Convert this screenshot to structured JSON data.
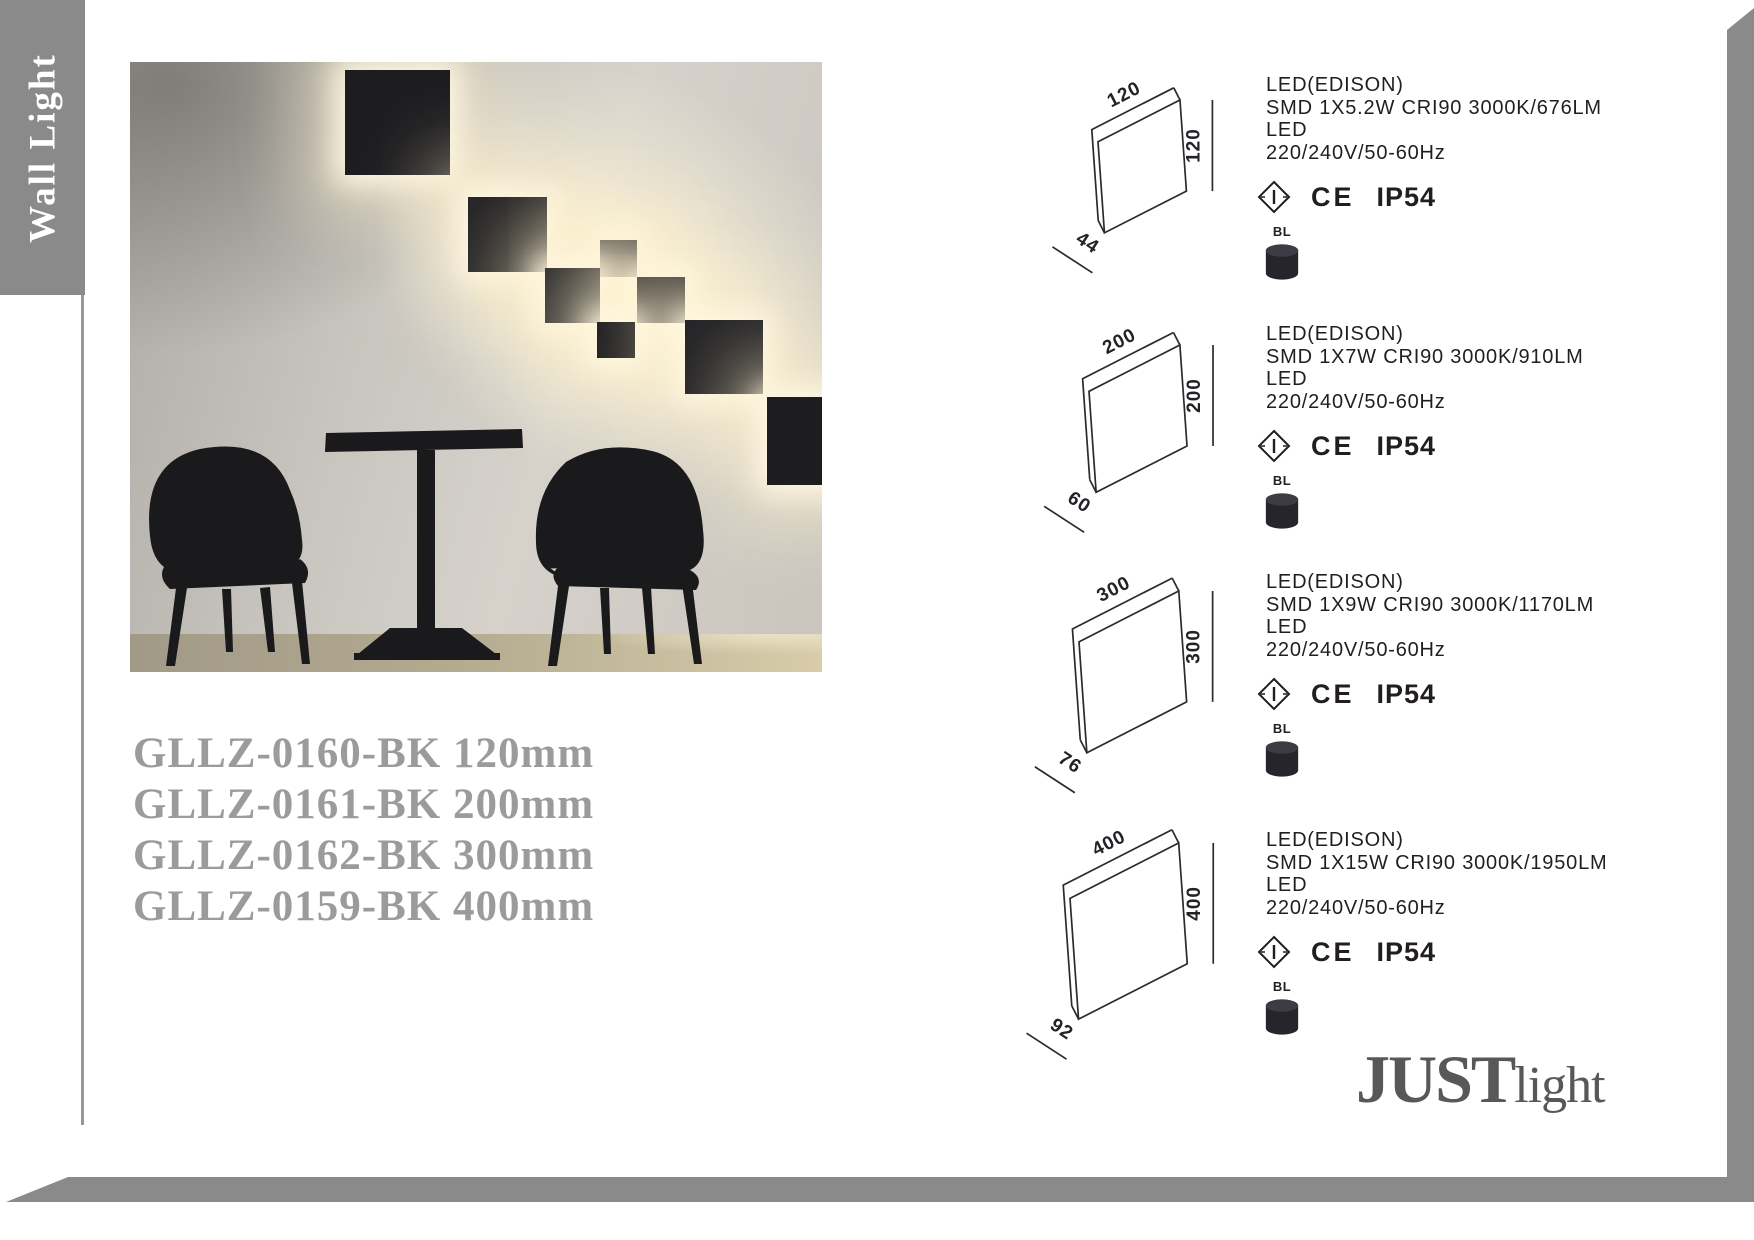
{
  "sidebar": {
    "label": "Wall Light"
  },
  "product_codes": [
    "GLLZ-0160-BK 120mm",
    "GLLZ-0161-BK 200mm",
    "GLLZ-0162-BK 300mm",
    "GLLZ-0159-BK 400mm"
  ],
  "products": [
    {
      "dims": {
        "width": "120",
        "height": "120",
        "depth": "44"
      },
      "specs": [
        "LED(EDISON)",
        "SMD 1X5.2W CRI90 3000K/676LM",
        "LED",
        "220/240V/50-60Hz"
      ],
      "certs": {
        "ce": "CE",
        "ip": "IP54"
      },
      "finish": "BL"
    },
    {
      "dims": {
        "width": "200",
        "height": "200",
        "depth": "60"
      },
      "specs": [
        "LED(EDISON)",
        "SMD 1X7W CRI90 3000K/910LM",
        "LED",
        "220/240V/50-60Hz"
      ],
      "certs": {
        "ce": "CE",
        "ip": "IP54"
      },
      "finish": "BL"
    },
    {
      "dims": {
        "width": "300",
        "height": "300",
        "depth": "76"
      },
      "specs": [
        "LED(EDISON)",
        "SMD 1X9W CRI90 3000K/1170LM",
        "LED",
        "220/240V/50-60Hz"
      ],
      "certs": {
        "ce": "CE",
        "ip": "IP54"
      },
      "finish": "BL"
    },
    {
      "dims": {
        "width": "400",
        "height": "400",
        "depth": "92"
      },
      "specs": [
        "LED(EDISON)",
        "SMD 1X15W CRI90 3000K/1950LM",
        "LED",
        "220/240V/50-60Hz"
      ],
      "certs": {
        "ce": "CE",
        "ip": "IP54"
      },
      "finish": "BL"
    }
  ],
  "logo": {
    "main": "JUST",
    "sub": "light"
  },
  "colors": {
    "bar_gray": "#8a8a8a",
    "code_gray": "#9b9b9b",
    "ink": "#231f20",
    "logo_gray": "#57585a",
    "glow_warm": "#fff5d9",
    "panel_black": "#1d1c1f"
  }
}
